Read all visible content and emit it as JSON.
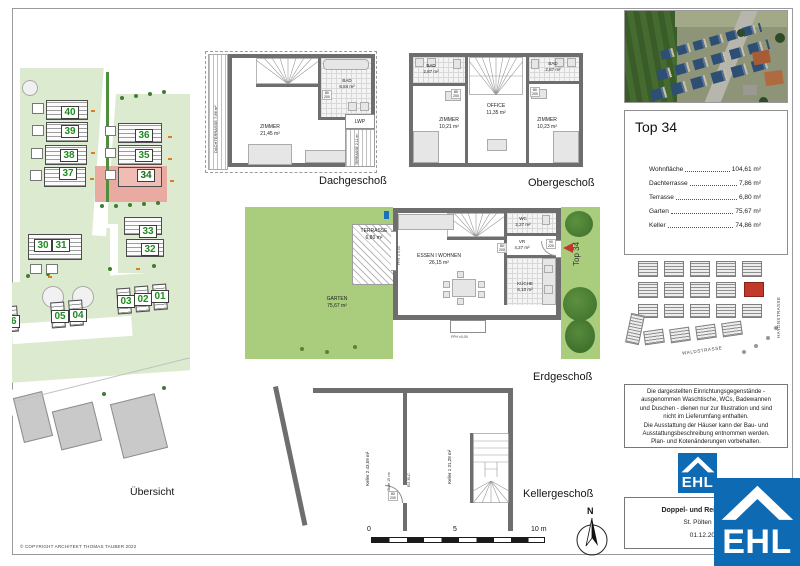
{
  "sheet": {
    "copyright": "© COPYRIGHT ARCHITEKT THOMAS TAUBER 2022"
  },
  "colors": {
    "ehl_blue": "#0e6ab2",
    "highlight_red": "#c0392b",
    "garden_green": "#a9cc7d",
    "parcel_pink": "#e9aaa1",
    "unit_number_green": "#1e8a1e"
  },
  "site_plan": {
    "label": "Übersicht",
    "units": [
      "40",
      "39",
      "38",
      "37",
      "36",
      "35",
      "34",
      "33",
      "32",
      "30",
      "31",
      "06",
      "05",
      "04",
      "03",
      "02",
      "01"
    ]
  },
  "floors": {
    "dach": {
      "label": "Dachgeschoß",
      "zimmer_name": "ZIMMER",
      "zimmer_area": "21,45 m²",
      "bad_name": "BAD",
      "bad_area": "6,84 m²",
      "lwp": "LWP",
      "dachterrasse_name": "DACHTERRASSE",
      "dachterrasse_area": "7,86 m²",
      "terrasse_name": "TERRASSE",
      "terrasse_area": "2,11 m²",
      "door_w": "80",
      "door_h": "200"
    },
    "ober": {
      "label": "Obergeschoß",
      "bad_left_name": "BAD",
      "bad_left_area": "2,87 m²",
      "bad_right_name": "BAD",
      "bad_right_area": "2,87 m²",
      "office_name": "OFFICE",
      "office_area": "11,35 m²",
      "zimmer_left_name": "ZIMMER",
      "zimmer_left_area": "10,21 m²",
      "zimmer_right_name": "ZIMMER",
      "zimmer_right_area": "10,23 m²",
      "door_w": "80",
      "door_h": "200"
    },
    "erd": {
      "label": "Erdgeschoß",
      "unit_tag": "Top 34",
      "terrasse_name": "TERRASSE",
      "terrasse_area": "6,80 m²",
      "garten_name": "GARTEN",
      "garten_area": "75,67 m²",
      "wohnen_name": "ESSEN I WOHNEN",
      "wohnen_area": "26,15 m²",
      "wc_name": "WC",
      "wc_area": "2,27 m²",
      "vr_name": "VR",
      "vr_area": "4,27 m²",
      "kueche_name": "KÜCHE",
      "kueche_area": "6,10 m²",
      "entry_door_w": "90",
      "entry_door_h": "220",
      "vr_door_w": "80",
      "vr_door_h": "200",
      "fph": "FPH ±0,00"
    },
    "keller": {
      "label": "Kellergeschoß",
      "keller1_name": "Keller 1",
      "keller1_area": "31,28 m²",
      "keller2_name": "Keller 2",
      "keller2_area": "43,59 m²",
      "stufe": "Stufe 15 cm",
      "fire_door": "EI2 30-C",
      "door_w": "80",
      "door_h": "200"
    }
  },
  "scale_bar": {
    "zero": "0",
    "five": "5",
    "ten": "10 m"
  },
  "north": {
    "label": "N"
  },
  "panel": {
    "info": {
      "title": "Top 34",
      "rows": [
        {
          "label": "Wohnfläche",
          "value": "104,61 m²"
        },
        {
          "label": "Dachterrasse",
          "value": "7,86 m²"
        },
        {
          "label": "Terrasse",
          "value": "6,80 m²"
        },
        {
          "label": "Garten",
          "value": "75,67 m²"
        },
        {
          "label": "Keller",
          "value": "74,86 m²"
        }
      ]
    },
    "map": {
      "street_right": "HAYDNSTRASSE",
      "street_bottom": "WALDSTRASSE"
    },
    "disclaimer": {
      "l1": "Die dargestellten Einrichtungsgegenstände -",
      "l2": "ausgenommen Waschtische, WCs, Badewannen",
      "l3": "und Duschen - dienen nur zur Illustration und sind",
      "l4": "nicht im Lieferumfang enthalten.",
      "l5": "Die Ausstattung der Häuser kann der Bau- und",
      "l6": "Ausstattungsbeschreibung entnommen werden.",
      "l7": "Plan- und Kotenänderungen vorbehalten."
    },
    "logo_text": "EHL",
    "project": {
      "name": "Doppel- und Reihenhäuser",
      "location": "St. Pölten I Nov",
      "date": "01.12.2022"
    }
  }
}
